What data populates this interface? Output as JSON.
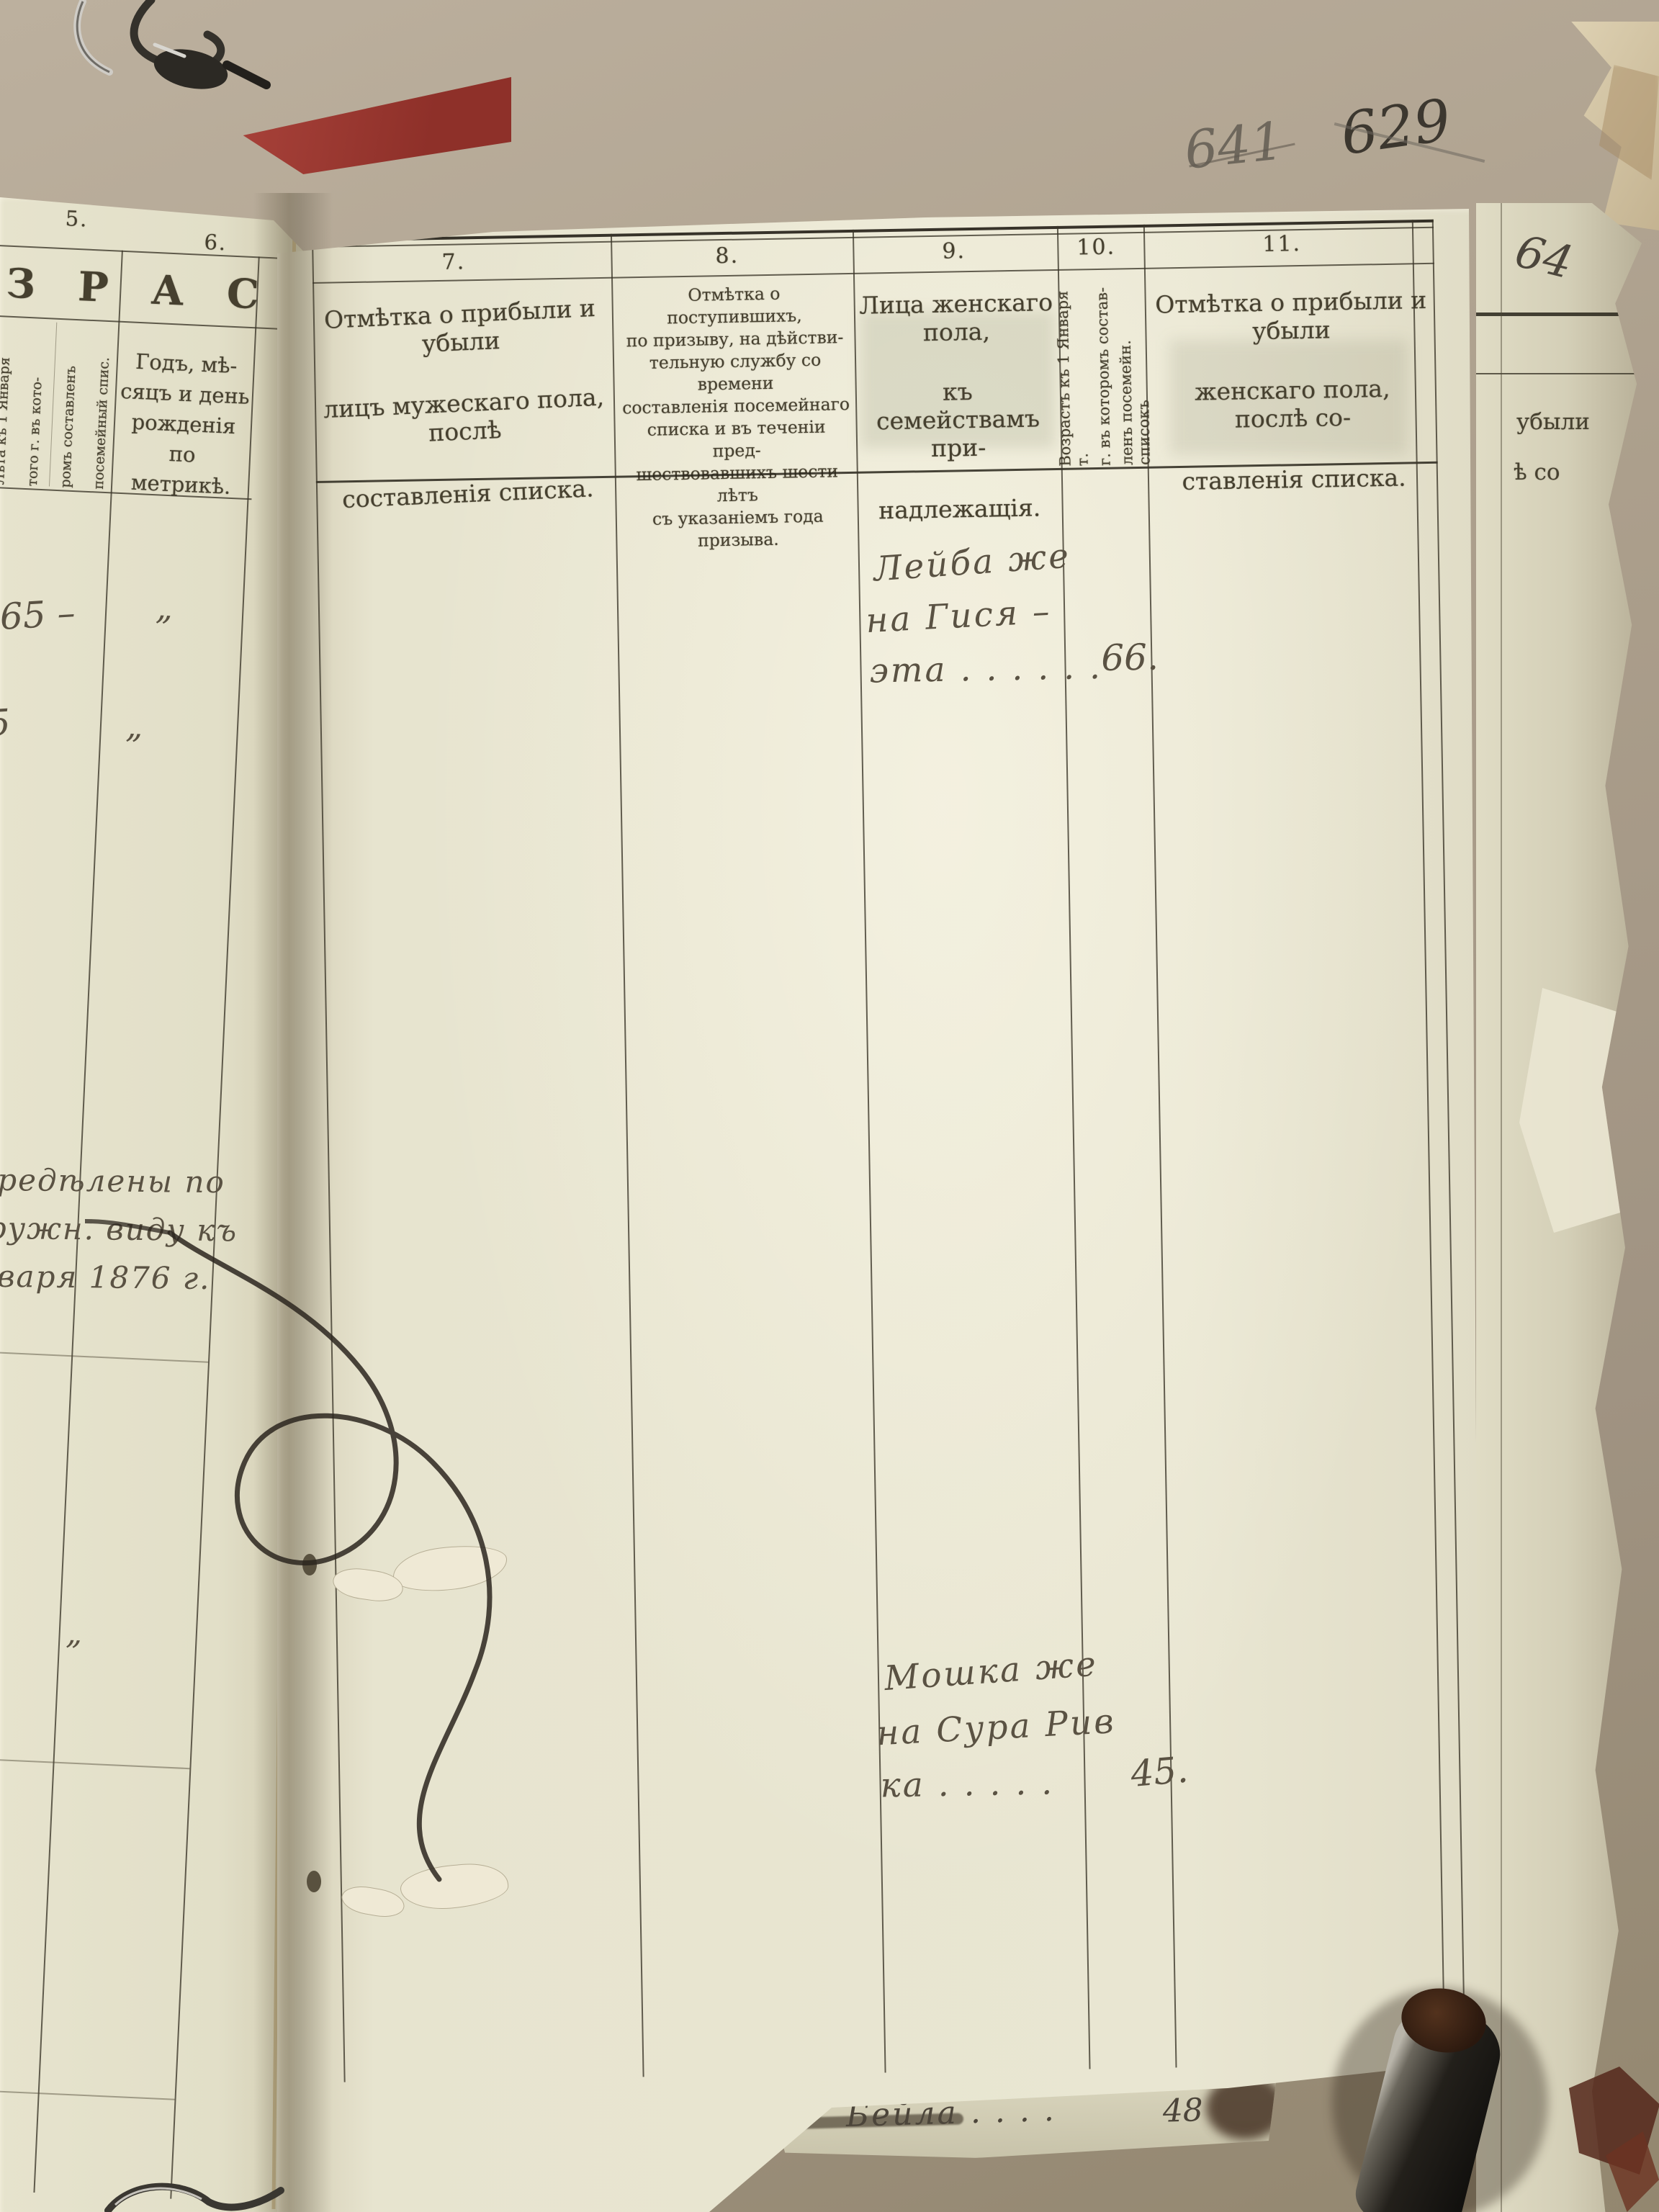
{
  "photo": {
    "page_number_old": "641",
    "page_number_new": "629"
  },
  "right_table": {
    "col_numbers": [
      "7.",
      "8.",
      "9.",
      "10.",
      "11."
    ],
    "col7_header": [
      "Отмѣтка о прибыли и убыли",
      "лицъ мужескаго пола, послѣ",
      "составленія списка."
    ],
    "col8_header": [
      "Отмѣтка о поступившихъ,",
      "по призыву, на дѣйстви-",
      "тельную службу со времени",
      "составленія посемейнаго",
      "списка и въ теченіи пред-",
      "шествовавшихъ шести лѣтъ",
      "съ указаніемъ года",
      "призыва."
    ],
    "col9_header": [
      "Лица женскаго пола,",
      "къ семействамъ при-",
      "надлежащія."
    ],
    "col10_header": [
      "Возрастъ къ 1 Января т.",
      "г. въ которомъ состав-",
      "ленъ посемейн. списокъ"
    ],
    "col11_header": [
      "Отмѣтка о прибыли и убыли",
      "женскаго пола, послѣ со-",
      "ставленія списка."
    ],
    "entry1": {
      "line1": "Лейба же",
      "line2": "на Гися –",
      "line3": "эта . . . . . .",
      "age": "66."
    },
    "entry2": {
      "line1": "Мошка же",
      "line2": "на Сура Рив",
      "line3": "ка . . . . .",
      "age": "45."
    }
  },
  "left_table": {
    "col_numbers": [
      "5.",
      "6."
    ],
    "group_header": "З Р А С Т Ъ.",
    "col5_vertical": [
      "Лѣта къ 1 Января",
      "того г. въ кото-",
      "ромъ составленъ",
      "посемейный спис."
    ],
    "col6_header": [
      "Годъ, мѣ-",
      "сяцъ и день",
      "рожденія по",
      "метрикѣ."
    ],
    "rows": [
      {
        "age": "65 –",
        "ditto": "„"
      },
      {
        "age": "25",
        "ditto": "„"
      },
      {
        "age": "45.",
        "ditto": "„"
      }
    ],
    "note": [
      "опредѣлены по",
      "наружн. виду къ",
      "Января 1876 г."
    ]
  },
  "under_page": {
    "number_fragment": "64",
    "text1": "убыли",
    "text2": "ѣ со"
  },
  "bottom_slip": {
    "script": "Бейла . . . .",
    "age": "48"
  }
}
